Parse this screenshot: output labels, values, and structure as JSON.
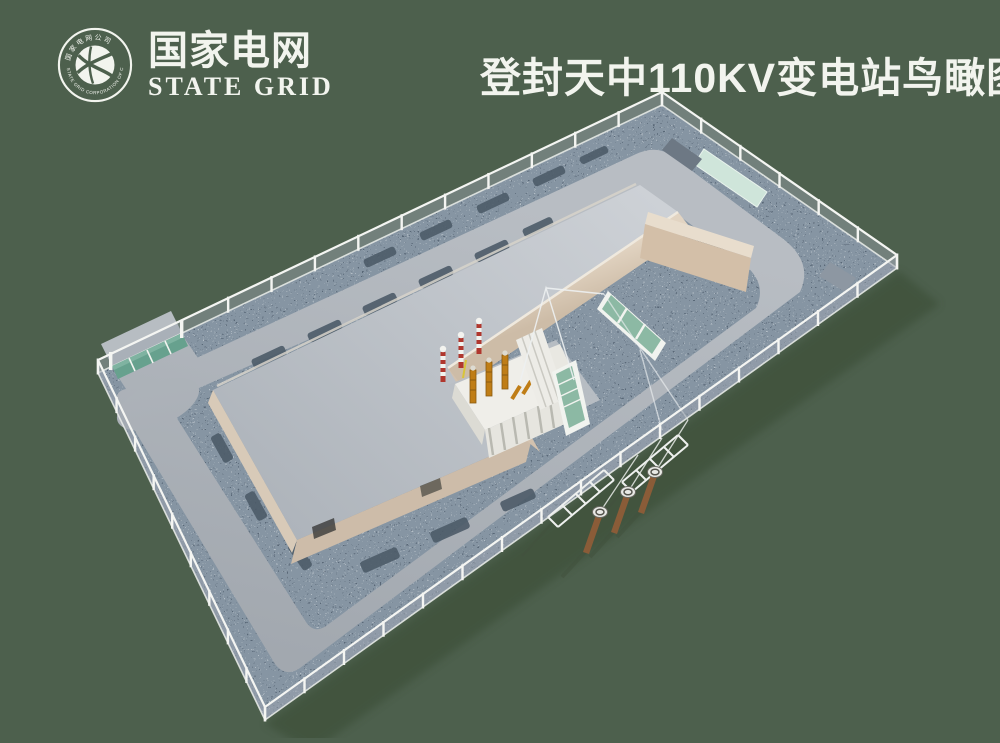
{
  "page": {
    "width": 1000,
    "height": 738,
    "background_color": "#4d604d"
  },
  "header": {
    "logo": {
      "ring_text_top": "国家电网公司",
      "ring_text_bottom": "STATE GRID CORPORATION OF CHINA",
      "name_zh": "国家电网",
      "name_en": "STATE GRID",
      "text_color": "#f2f4ee"
    },
    "title": {
      "text": "登封天中110KV变电站鸟瞰图",
      "color": "#f2f4ee"
    }
  },
  "scene": {
    "type": "3d-aerial-rendering",
    "subject": "Bird's-eye view rendering of the Dengfeng Tianzhong 110KV substation compound",
    "elements": [
      "perimeter-chain-link-fence",
      "teal-entrance-gate",
      "entrance-apron",
      "gravel-ground",
      "ring-road",
      "main-building-flat-roof",
      "courtyard-parapet-wall",
      "transformer-unit",
      "transformer-bushings",
      "radiator-fins",
      "striped-arrester-poles",
      "green-switch-screens",
      "white-control-cabinets",
      "mint-equipment-pad",
      "gray-equipment-pads",
      "shrub-beds",
      "lattice-line-gantries",
      "cable-terminal-poles",
      "overhead-conductors"
    ],
    "palette": {
      "background": "#4d604d",
      "gravel": "#8695a3",
      "gravel_dark": "#4d5b68",
      "road": "#adb3ba",
      "roof": "#bfc4ca",
      "wall_beige": "#d9cab8",
      "gate_teal": "#67a18e",
      "mint_pad": "#cfe5da",
      "transformer_white": "#ebeae4",
      "bushing_orange": "#bf7d16",
      "stripe_red": "#b0372e",
      "screen_green": "#8cb9a4",
      "fence_white": "#f4f5f2"
    }
  }
}
